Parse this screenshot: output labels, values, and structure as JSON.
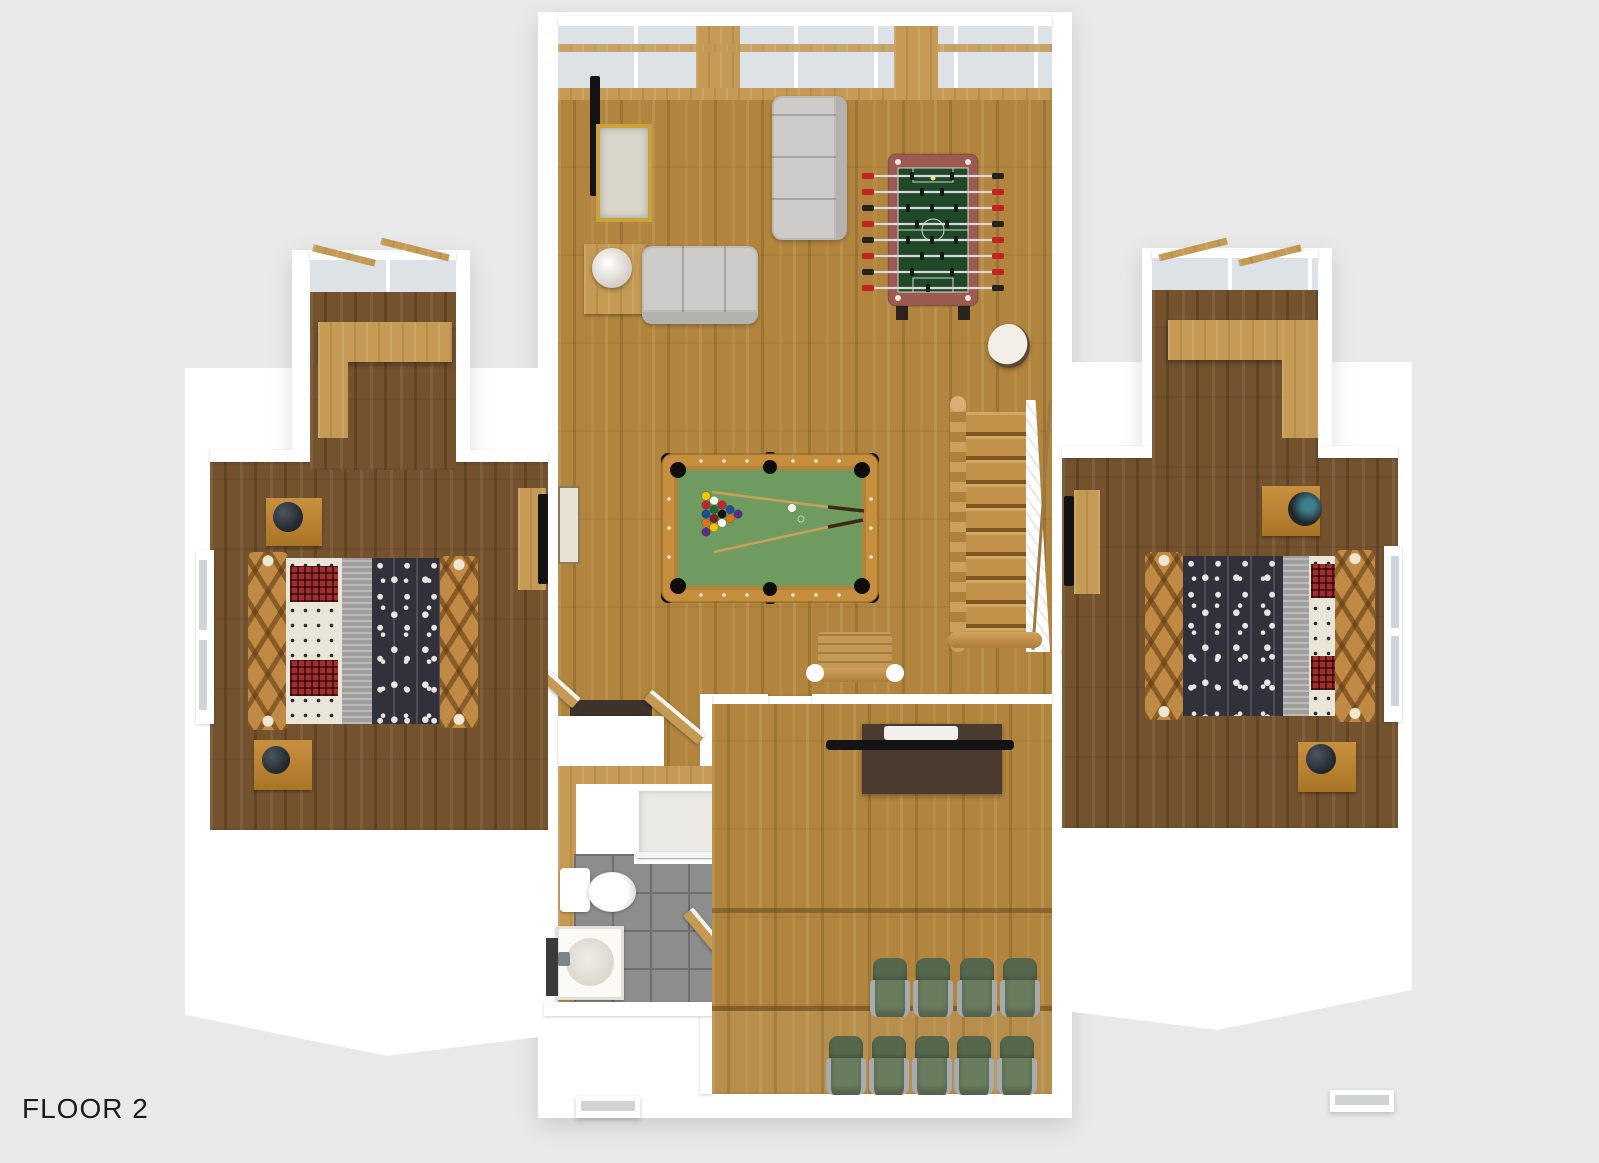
{
  "title": {
    "floor_label": "FLOOR 2"
  },
  "palette": {
    "bg": "#e9e9e9",
    "roof": "#ffffff",
    "oak": "#b1853d",
    "darkwood": "#74522e",
    "tanwood": "#c49a55",
    "glass": "#dde2e6",
    "felt": "#6f9a60",
    "rail": "#c68f3e",
    "chairGreen": "#55684d",
    "sofaGray": "#cccbc9",
    "duvet": "#30313a",
    "plaid": "#a32c2c",
    "tile": "#8d8d8d",
    "console": "#4a3a30",
    "black": "#131313"
  },
  "scene": {
    "view": "3d-floorplan-top-down",
    "rooms": [
      {
        "name": "game-room",
        "furniture": [
          "wall-tv",
          "gold-console-table",
          "side-table-with-lamp",
          "loveseat",
          "three-seat-sofa",
          "foosball-table",
          "round-stool",
          "pool-table",
          "log-bench",
          "staircase"
        ]
      },
      {
        "name": "bedroom-left",
        "furniture": [
          "log-bed-animal-print",
          "nightstand-with-lamp",
          "nightstand-with-lamp",
          "dresser-with-tv",
          "dormer-desk",
          "windows"
        ]
      },
      {
        "name": "bedroom-right",
        "furniture": [
          "log-bed-animal-print",
          "nightstand-with-lamp",
          "nightstand-with-lamp",
          "dresser-with-tv",
          "dormer-desk",
          "windows"
        ]
      },
      {
        "name": "bathroom",
        "furniture": [
          "shower",
          "toilet",
          "sink-vanity",
          "door"
        ]
      },
      {
        "name": "theater-room",
        "furniture": [
          "flat-tv",
          "media-console",
          "recliner-chairs"
        ],
        "seats_back_row": 4,
        "seats_front_row": 5
      }
    ],
    "pool_table": {
      "balls_racked": 15,
      "cue_ball": 1,
      "cues": 2
    }
  }
}
